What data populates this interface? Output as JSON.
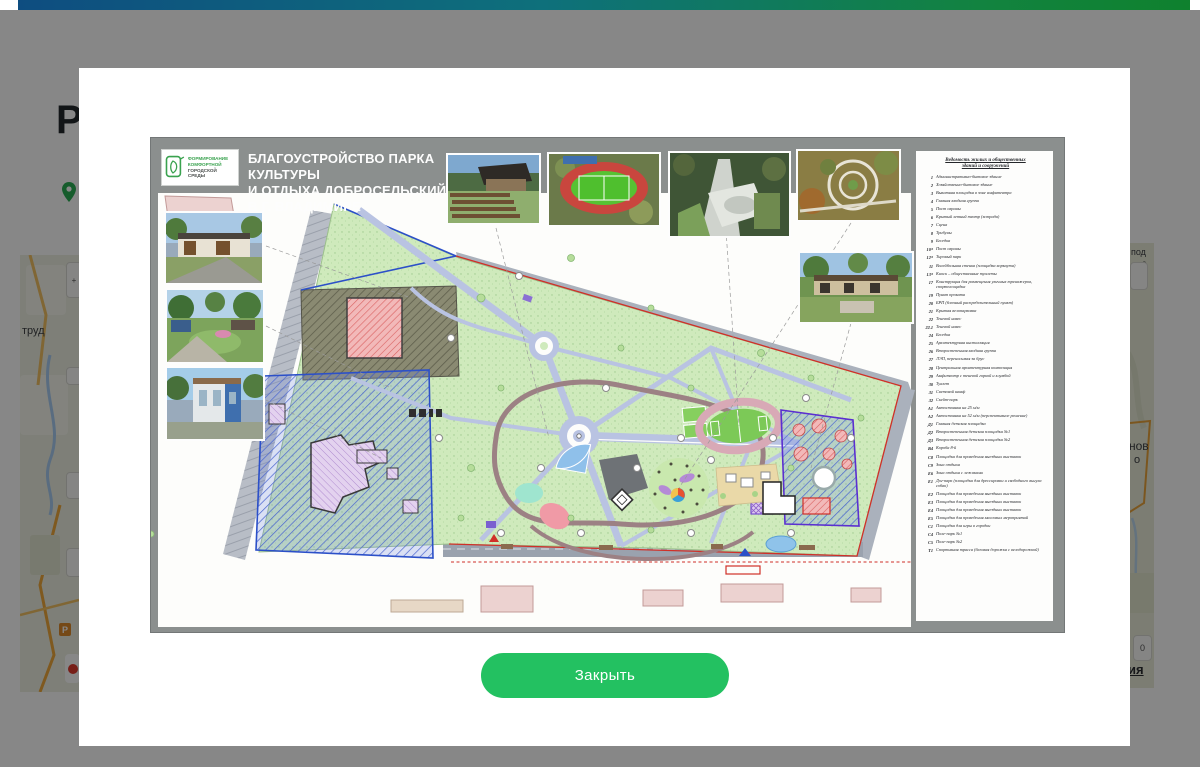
{
  "topbar": {
    "gradient_left": "#0e4d80",
    "gradient_mid": "#0e707b",
    "gradient_right": "#0f812e"
  },
  "page": {
    "heading_visible_text": "Р",
    "pin_color": "#2aae54",
    "map_left": {
      "visible_label": "труд",
      "parking_glyph": "Р"
    },
    "map_right": {
      "label_top1": "под",
      "label_top2": "о",
      "label_mid1": "нов",
      "label_mid2": "о",
      "button_glyph": "0",
      "visible_link_text": "ия"
    }
  },
  "modal": {
    "close_button_label": "Закрыть",
    "close_button_color": "#23c161"
  },
  "poster": {
    "frame_color": "#8b8f8e",
    "logo": {
      "line1": "ФОРМИРОВАНИЕ",
      "line2": "КОМФОРТНОЙ",
      "line3": "ГОРОДСКОЙ СРЕДЫ"
    },
    "title_line1": "БЛАГОУСТРОЙСТВО ПАРКА КУЛЬТУРЫ",
    "title_line2": "И ОТДЫХА ДОБРОСЕЛЬСКИЙ",
    "title_line3": "В Г. ВЛАДИМИРЕ",
    "photo_names": [
      "amphitheater-aerial",
      "stadium-aerial",
      "skatepark-aerial",
      "garden-aerial",
      "pavilion-render",
      "entrance-building-render",
      "garden-plaza-render",
      "cube-building-render"
    ],
    "legend": {
      "title_line1": "Ведомость жилых и общественных",
      "title_line2": "зданий и сооружений",
      "items": [
        {
          "n": "1",
          "t": "Административно-бытовое здание"
        },
        {
          "n": "2",
          "t": "Хозяйственно-бытовое здание"
        },
        {
          "n": "3",
          "t": "Выкатная площадка в зоне амфитеатра"
        },
        {
          "n": "4",
          "t": "Главная входная группа"
        },
        {
          "n": "5",
          "t": "Пост охраны"
        },
        {
          "n": "6",
          "t": "Крытый летний театр (эстрада)"
        },
        {
          "n": "7",
          "t": "Сцена"
        },
        {
          "n": "8",
          "t": "Трибуны"
        },
        {
          "n": "9",
          "t": "Беседка"
        },
        {
          "n": "10*",
          "t": "Пост охраны"
        },
        {
          "n": "12*",
          "t": "Тировый парк"
        },
        {
          "n": "11",
          "t": "Волейбольная стенка (площадка воркаута)"
        },
        {
          "n": "13*",
          "t": "Киоск – общественные туалеты"
        },
        {
          "n": "17",
          "t": "Конструкция для размещения уличных тренажеров, спортплощадка"
        },
        {
          "n": "19",
          "t": "Пункт проката"
        },
        {
          "n": "20",
          "t": "БРП (блочный распределительный пункт)"
        },
        {
          "n": "21",
          "t": "Крытая велопарковка"
        },
        {
          "n": "22",
          "t": "Теневой навес"
        },
        {
          "n": "22.1",
          "t": "Теневой навес"
        },
        {
          "n": "24",
          "t": "Беседка"
        },
        {
          "n": "25",
          "t": "Архитектурная инсталляция"
        },
        {
          "n": "26",
          "t": "Второстепенная входная группа"
        },
        {
          "n": "27",
          "t": "ЛЭП, переносимая за брус"
        },
        {
          "n": "28",
          "t": "Центральная архитектурная композиция"
        },
        {
          "n": "29",
          "t": "Амфитеатр с теневой горкой и клумбой"
        },
        {
          "n": "30",
          "t": "Туалет"
        },
        {
          "n": "31",
          "t": "Световой шкаф"
        },
        {
          "n": "32",
          "t": "Скейт-парк"
        },
        {
          "n": "А1",
          "t": "Автостоянка на 25 м/м"
        },
        {
          "n": "А2",
          "t": "Автостоянка на 52 м/м (перспективное решение)"
        },
        {
          "n": "Д1",
          "t": "Главная детская площадка"
        },
        {
          "n": "Д2",
          "t": "Второстепенная детская площадка №1"
        },
        {
          "n": "Д3",
          "t": "Второстепенная детская площадка №2"
        },
        {
          "n": "В4",
          "t": "Короба 8-й"
        },
        {
          "n": "С8",
          "t": "Площадка для проведения выездных выставок"
        },
        {
          "n": "С9",
          "t": "Зона отдыха"
        },
        {
          "n": "Е6",
          "t": "Зона отдыха с лежаками"
        },
        {
          "n": "Е1",
          "t": "Дог-парк (площадка для дрессировки и свободного выгула собак)"
        },
        {
          "n": "Е2",
          "t": "Площадка для проведения выездных выставок"
        },
        {
          "n": "Е3",
          "t": "Площадка для проведения выездных выставок"
        },
        {
          "n": "Е4",
          "t": "Площадка для проведения выездных выставок"
        },
        {
          "n": "Е5",
          "t": "Площадка для проведения массовых мероприятий"
        },
        {
          "n": "С1",
          "t": "Площадка для игры в городки"
        },
        {
          "n": "С4",
          "t": "Поле-парк №1"
        },
        {
          "n": "С5",
          "t": "Поле-парк №2"
        },
        {
          "n": "Т1",
          "t": "Спортивная трасса (беговая дорожка с велодорожкой)"
        }
      ]
    }
  }
}
